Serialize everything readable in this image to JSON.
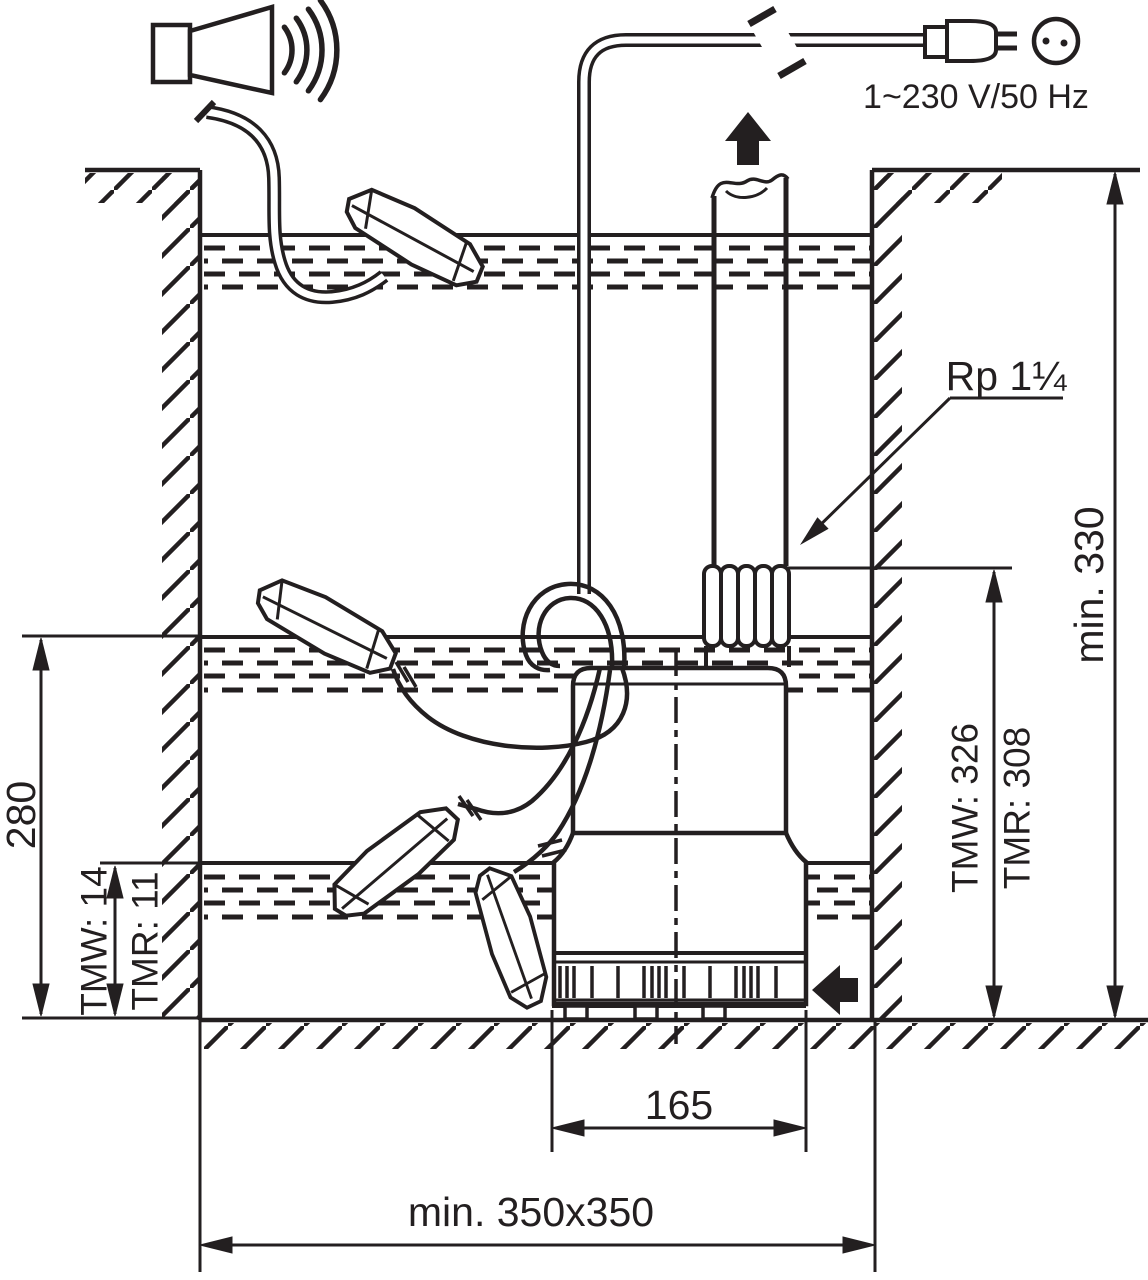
{
  "figure": {
    "title": "Submersible pump pit installation drawing",
    "ink_color": "#231f20",
    "background_color": "#ffffff"
  },
  "labels": {
    "power_rating": "1~230 V/50 Hz",
    "thread_size": "Rp 1¼",
    "pit_depth": "min. 330",
    "pump_height_tmw": "TMW: 326",
    "pump_height_tmr": "TMR: 308",
    "switch_on_level": "280",
    "residual_level_tmw": "TMW: 14",
    "residual_level_tmr": "TMR: 11",
    "base_width": "165",
    "pit_floor_size": "min. 350x350"
  },
  "icons": {
    "alarm_horn_icon": "loudspeaker horn with sound waves",
    "power_plug_icon": "two-pin mains plug",
    "power_socket_icon": "round socket outlet with two pin holes",
    "cable_break_icon": "diagonal cable-length break marks",
    "flow_up_arrow_icon": "solid arrow up (discharge flow)",
    "inflow_arrow_icon": "solid arrow left (inflow)",
    "thread_callout_arrow_icon": "leader arrow to pipe thread"
  },
  "components": [
    "sump pit with hatched walls and floor",
    "submersible pump with suction strainer",
    "carrying handle with float switch cables",
    "threaded discharge coupling",
    "vertical discharge pipe",
    "three water levels (alarm / on / off)",
    "four float switches",
    "alarm horn signal device"
  ]
}
